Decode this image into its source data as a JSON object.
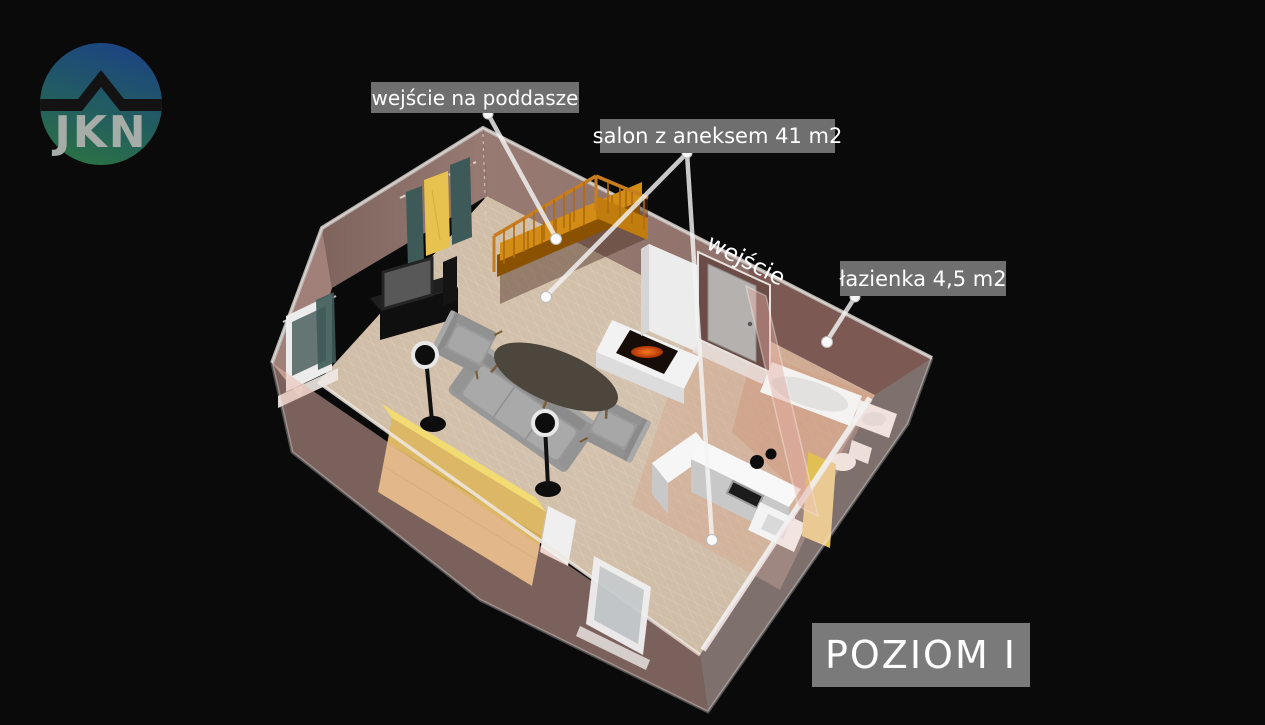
{
  "page": {
    "background": "#0a0a0a",
    "width": 1265,
    "height": 725
  },
  "logo": {
    "text": "JKN",
    "gradient_top_color": "#1d4a8c",
    "gradient_bottom_color": "#2d7a4b",
    "roof_color": "#141414",
    "text_color": "#b4bab6"
  },
  "annotations": {
    "box_bg": "#6f6f6f",
    "box_text_color": "#ffffff",
    "attic": {
      "text": "wejście na poddasze"
    },
    "salon": {
      "text": "salon z aneksem 41 m2"
    },
    "entrance": {
      "text": "wejście"
    },
    "bathroom": {
      "text": "łazienka 4,5 m2"
    },
    "level_badge": {
      "text": "POZIOM I",
      "bg": "#7a7a7a"
    }
  },
  "floorplan": {
    "view": "3d-perspective-floorplan",
    "floor_color": "#cfbca6",
    "grid_color": "#e4d7c3",
    "wall_color": "#8d7069",
    "bathroom_wall_color": "#7c5952",
    "front_wall_tint": "rgba(233,183,172,0.5)",
    "stairs_color": "#d38c16",
    "sofa_color": "#999999",
    "wardrobe_color": "#e0bb60",
    "leader_line_color": "#f4f4f4",
    "rooms": [
      {
        "name": "salon z aneksem",
        "area": "41 m2"
      },
      {
        "name": "łazienka",
        "area": "4,5 m2"
      }
    ],
    "objects": [
      "staircase-to-attic",
      "stair-railing",
      "tv-cabinet",
      "tv",
      "yellow-wall-hanging",
      "curtains",
      "window-left-wall",
      "sofa",
      "armchair-left",
      "armchair-right",
      "coffee-table",
      "floor-lamp-left",
      "floor-lamp-right",
      "wardrobe-bed",
      "fireplace",
      "entrance-door",
      "kitchen-counter",
      "stove",
      "oven",
      "kitchen-sink",
      "bathtub",
      "washbasin",
      "toilet",
      "bathroom-door-yellow",
      "window-front-wall"
    ]
  }
}
